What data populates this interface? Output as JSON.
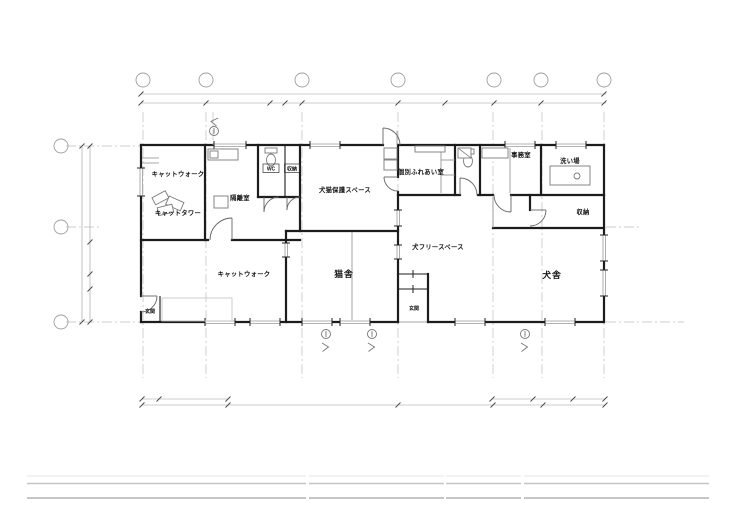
{
  "sheet": {
    "background": "#ffffff",
    "type": "architectural floor plan"
  },
  "colors": {
    "wall": "#1c1c1c",
    "thin_line": "#8a8a8a",
    "dimension": "#9a9a9a",
    "grid_centerline": "#bcbcbc",
    "label": "#121212",
    "titleblock": "#b2b2b2"
  },
  "labels": {
    "cat_walk_upper": "キャットウォーク",
    "cat_tower": "キャットタワー",
    "isolation_room": "隔離室",
    "wc": "WC",
    "storage_small": "収納",
    "dog_cat_rescue_space": "犬猫保護スペース",
    "individual_interaction_room": "個別ふれあい室",
    "office": "事務室",
    "washing_area": "洗い場",
    "storage_right": "収納",
    "cat_walk_lower": "キャットウォーク",
    "cat_house": "猫舎",
    "dog_free_space": "犬フリースペース",
    "dog_house": "犬舎",
    "entrance_left": "玄関",
    "entrance_center": "玄関"
  }
}
